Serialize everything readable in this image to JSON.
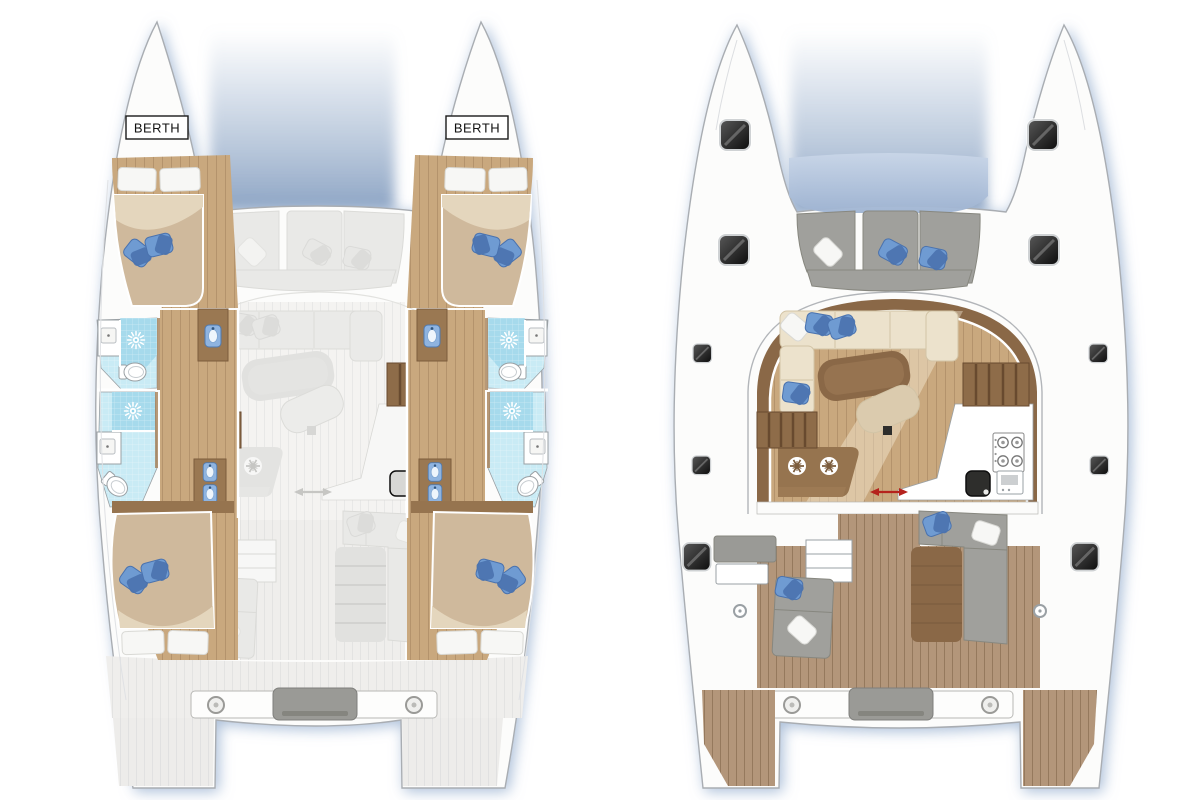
{
  "page": {
    "background": "#ffffff"
  },
  "labels": {
    "berth_port": "BERTH",
    "berth_starboard": "BERTH"
  },
  "icons": {
    "shower": "sunburst-icon",
    "fridge": "snowflake-icon",
    "deck_hatch": "dark-square-hatch",
    "sliding_door": "red-double-arrow",
    "stove": "four-burner-hob",
    "toilet": "wc-oval",
    "washbasin": "blue-basin"
  },
  "colors": {
    "background": "#ffffff",
    "hull_stroke": "#a9adb2",
    "shadow": "#9db4d2",
    "gap_shade": "#8fa7c6",
    "wood_floor": "#c9a87e",
    "wood_band": "#8a6847",
    "teak": "#b3967a",
    "pale_deck": "#efeeec",
    "tile": "#a6daec",
    "tile_light": "#c9ebf5",
    "mattress": "#cfb99c",
    "mattress_light": "#e4d6bd",
    "pillow_white": "#f7f7f5",
    "pillow_blue": "#6f9bd2",
    "pillow_blue_dark": "#4a72ae",
    "sofa_cream": "#ece2cc",
    "table_brown": "#8a6847",
    "ottoman": "#dbcbae",
    "seat_gray": "#a0a09c",
    "counter_gray": "#9a9a96",
    "stair_wood": "#8e6c49",
    "stair_gap": "#684a2f",
    "vanity_wood": "#9a7852",
    "sink_blue": "#8fb4e0",
    "hatch_dark": "#161616",
    "arrow_red": "#b5231d",
    "berth_text": "#111111"
  }
}
